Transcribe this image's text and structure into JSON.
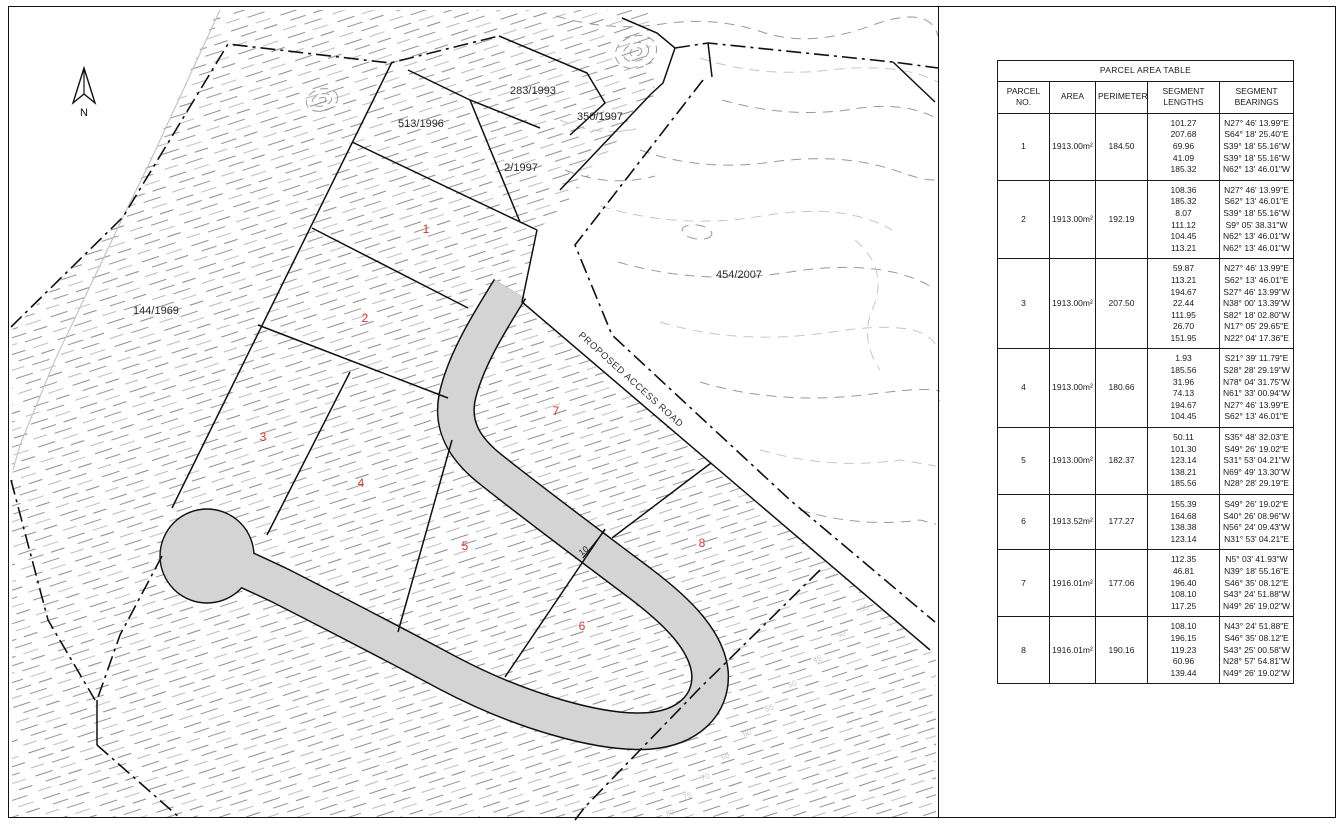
{
  "drawing": {
    "compass": "N",
    "road_label": "PROPOSED ACCESS ROAD",
    "road_width_label": "10",
    "neighbor_parcels": {
      "p283": "283/1993",
      "p513": "513/1996",
      "p350": "350/1997",
      "p2": "2/1997",
      "p454": "454/2007",
      "p144": "144/1969"
    },
    "parcel_numbers": [
      "1",
      "2",
      "3",
      "4",
      "5",
      "6",
      "7",
      "8"
    ],
    "contour_elevations": [
      "35",
      "40",
      "45",
      "50",
      "55",
      "60",
      "65",
      "70",
      "75",
      "80"
    ]
  },
  "table": {
    "title": "PARCEL AREA TABLE",
    "columns": [
      "PARCEL NO.",
      "AREA",
      "PERIMETER",
      "SEGMENT LENGTHS",
      "SEGMENT BEARINGS"
    ],
    "rows": [
      {
        "no": "1",
        "area": "1913.00m²",
        "perimeter": "184.50",
        "lengths": [
          "101.27",
          "207.68",
          "69.96",
          "41.09",
          "185.32"
        ],
        "bearings": [
          "N27° 46' 13.99\"E",
          "S64° 18' 25.40\"E",
          "S39° 18' 55.16\"W",
          "S39° 18' 55.16\"W",
          "N62° 13' 46.01\"W"
        ]
      },
      {
        "no": "2",
        "area": "1913.00m²",
        "perimeter": "192.19",
        "lengths": [
          "108.36",
          "185.32",
          "8.07",
          "111.12",
          "104.45",
          "113.21"
        ],
        "bearings": [
          "N27° 46' 13.99\"E",
          "S62° 13' 46.01\"E",
          "S39° 18' 55.16\"W",
          "S9° 05' 38.31\"W",
          "N62° 13' 46.01\"W",
          "N62° 13' 46.01\"W"
        ]
      },
      {
        "no": "3",
        "area": "1913.00m²",
        "perimeter": "207.50",
        "lengths": [
          "59.87",
          "113.21",
          "194.67",
          "22.44",
          "111.95",
          "26.70",
          "151.95"
        ],
        "bearings": [
          "N27° 46' 13.99\"E",
          "S62° 13' 46.01\"E",
          "S27° 46' 13.99\"W",
          "N38° 00' 13.39\"W",
          "S82° 18' 02.80\"W",
          "N17° 05' 29.65\"E",
          "N22° 04' 17.36\"E"
        ]
      },
      {
        "no": "4",
        "area": "1913.00m²",
        "perimeter": "180.66",
        "lengths": [
          "1.93",
          "185.56",
          "31.96",
          "74.13",
          "194.67",
          "104.45"
        ],
        "bearings": [
          "S21° 39' 11.79\"E",
          "S28° 28' 29.19\"W",
          "N78° 04' 31.75\"W",
          "N61° 33' 00.94\"W",
          "N27° 46' 13.99\"E",
          "S62° 13' 46.01\"E"
        ]
      },
      {
        "no": "5",
        "area": "1913.00m²",
        "perimeter": "182.37",
        "lengths": [
          "50.11",
          "101.30",
          "123.14",
          "138.21",
          "185.56"
        ],
        "bearings": [
          "S35° 48' 32.03\"E",
          "S49° 26' 19.02\"E",
          "S31° 53' 04.21\"W",
          "N69° 49' 13.30\"W",
          "N28° 28' 29.19\"E"
        ]
      },
      {
        "no": "6",
        "area": "1913.52m²",
        "perimeter": "177.27",
        "lengths": [
          "155.39",
          "164.68",
          "138.38",
          "123.14"
        ],
        "bearings": [
          "S49° 26' 19.02\"E",
          "S40° 26' 08.96\"W",
          "N56° 24' 09.43\"W",
          "N31° 53' 04.21\"E"
        ]
      },
      {
        "no": "7",
        "area": "1916.01m²",
        "perimeter": "177.06",
        "lengths": [
          "112.35",
          "46.81",
          "196.40",
          "108.10",
          "117.25"
        ],
        "bearings": [
          "N5° 03' 41.93\"W",
          "N39° 18' 55.16\"E",
          "S46° 35' 08.12\"E",
          "S43° 24' 51.88\"W",
          "N49° 26' 19.02\"W"
        ]
      },
      {
        "no": "8",
        "area": "1916.01m²",
        "perimeter": "190.16",
        "lengths": [
          "108.10",
          "196.15",
          "119.23",
          "60.96",
          "139.44"
        ],
        "bearings": [
          "N43° 24' 51.88\"E",
          "S46° 35' 08.12\"E",
          "S43° 25' 00.58\"W",
          "N28° 57' 54.81\"W",
          "N49° 26' 19.02\"W"
        ]
      }
    ]
  },
  "colors": {
    "road_fill": "#d4d4d4",
    "parcel_number_red": "#e03232",
    "line_black": "#111111",
    "contour_gray": "#9a9a9a",
    "contour_light": "#c6c6c6"
  }
}
